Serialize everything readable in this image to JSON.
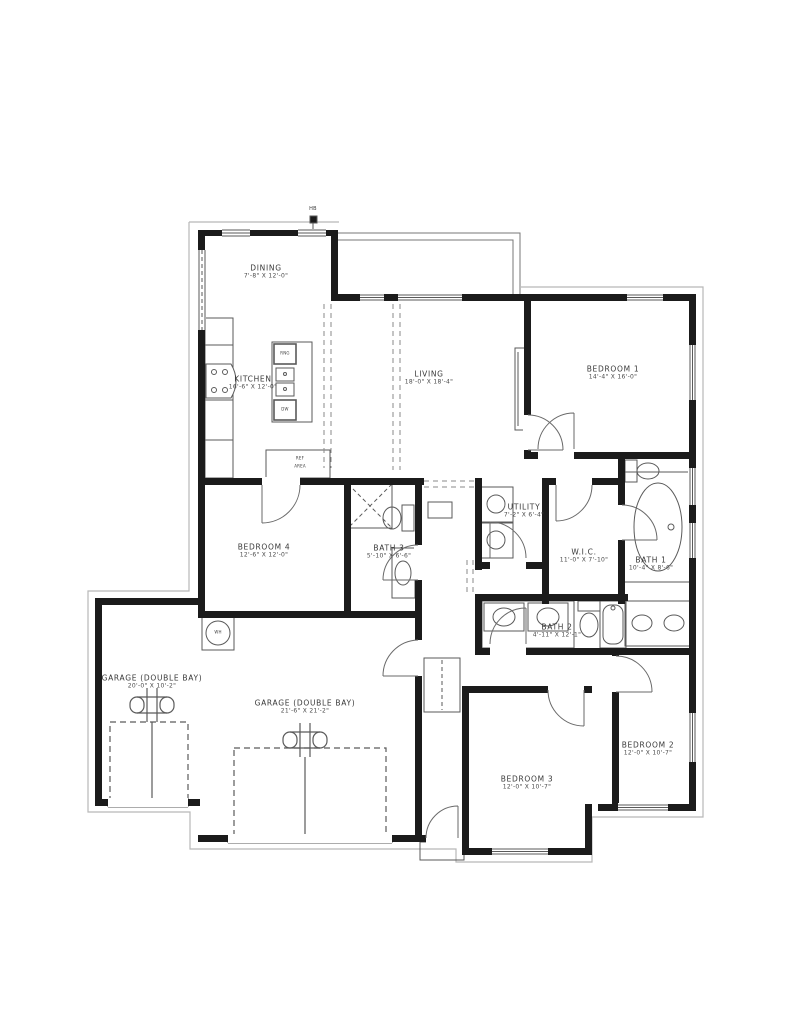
{
  "rooms": {
    "dining": {
      "name": "DINING",
      "dims": "7'-8\" X 12'-0\""
    },
    "kitchen": {
      "name": "KITCHEN",
      "dims": "16'-6\" X 12'-0\""
    },
    "living": {
      "name": "LIVING",
      "dims": "18'-0\" X 18'-4\""
    },
    "bedroom1": {
      "name": "BEDROOM 1",
      "dims": "14'-4\" X 16'-0\""
    },
    "bedroom4": {
      "name": "BEDROOM 4",
      "dims": "12'-6\" X 12'-0\""
    },
    "bath3": {
      "name": "BATH 3",
      "dims": "5'-10\" X 6'-6\""
    },
    "utility": {
      "name": "UTILITY",
      "dims": "7'-2\" X 6'-4\""
    },
    "wic": {
      "name": "W.I.C.",
      "dims": "11'-0\" X 7'-10\""
    },
    "bath1": {
      "name": "BATH 1",
      "dims": "10'-4\" X 8'-6\""
    },
    "bath2": {
      "name": "BATH 2",
      "dims": "4'-11\" X 12'-1\""
    },
    "garage_left": {
      "name": "GARAGE (DOUBLE BAY)",
      "dims": "20'-0\" X 10'-2\""
    },
    "garage_main": {
      "name": "GARAGE (DOUBLE BAY)",
      "dims": "21'-6\" X 21'-2\""
    },
    "bedroom3": {
      "name": "BEDROOM 3",
      "dims": "12'-0\" X 10'-7\""
    },
    "bedroom2": {
      "name": "BEDROOM 2",
      "dims": "12'-0\" X 10'-7\""
    }
  },
  "markers": {
    "water_heater": "WH",
    "hose_bib": "HB",
    "dishwasher": "DW",
    "range": "RNG",
    "ref_line1": "REF",
    "ref_line2": "AREA"
  },
  "colors": {
    "wall": "#1b1b1b",
    "fixture_line": "#5a5a5a",
    "outline": "#b8b8b8",
    "background": "#ffffff"
  }
}
